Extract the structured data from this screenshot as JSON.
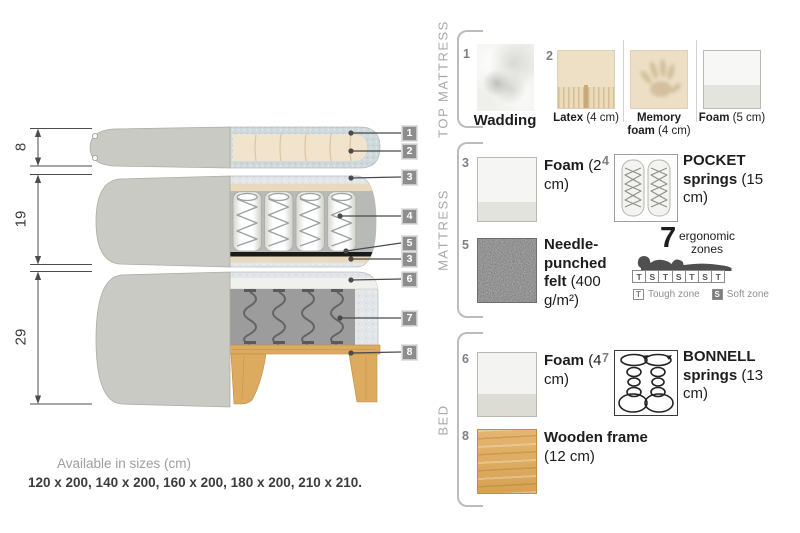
{
  "diagram": {
    "dims": [
      "8",
      "19",
      "29"
    ],
    "callouts": [
      "1",
      "2",
      "3",
      "4",
      "5",
      "3",
      "6",
      "7",
      "8"
    ]
  },
  "legend": {
    "sections": [
      {
        "label": "TOP MATTRESS"
      },
      {
        "label": "MATTRESS"
      },
      {
        "label": "BED"
      }
    ],
    "items": {
      "wadding": {
        "num": "1",
        "name": "Wadding",
        "detail": ""
      },
      "latex": {
        "num": "2",
        "name": "Latex",
        "detail": "(4 cm)"
      },
      "memory": {
        "name": "Memory foam",
        "detail": "(4 cm)"
      },
      "foam5": {
        "name": "Foam",
        "detail": "(5 cm)"
      },
      "foam2": {
        "num": "3",
        "name": "Foam",
        "detail": "(2 cm)"
      },
      "pocket": {
        "num": "4",
        "name": "POCKET springs",
        "detail": "(15 cm)"
      },
      "felt": {
        "num": "5",
        "name": "Needle-punched felt",
        "detail": "(400 g/m²)"
      },
      "foam4": {
        "num": "6",
        "name": "Foam",
        "detail": "(4 cm)"
      },
      "bonnell": {
        "num": "7",
        "name": "BONNELL springs",
        "detail": "(13 cm)"
      },
      "frame": {
        "num": "8",
        "name": "Wooden frame",
        "detail": "(12 cm)"
      }
    },
    "ergonomic": {
      "number": "7",
      "label_line1": "ergonomic",
      "label_line2": "zones",
      "zones": [
        "T",
        "S",
        "T",
        "S",
        "T",
        "S",
        "T"
      ],
      "tough_key": "T",
      "tough_label": "Tough zone",
      "soft_key": "S",
      "soft_label": "Soft zone"
    }
  },
  "sizes": {
    "title": "Available in sizes (cm)",
    "values": "120 x 200, 140 x 200, 160 x 200, 180 x 200, 210 x 210."
  },
  "colors": {
    "fabric_grey": "#c9cac3",
    "wadding_blue": "#d3dcdf",
    "foam_beige": "#f2e4cc",
    "felt_black": "#1a1a1a",
    "wood": "#dcab60",
    "callout_grey": "#8d8d8d"
  }
}
